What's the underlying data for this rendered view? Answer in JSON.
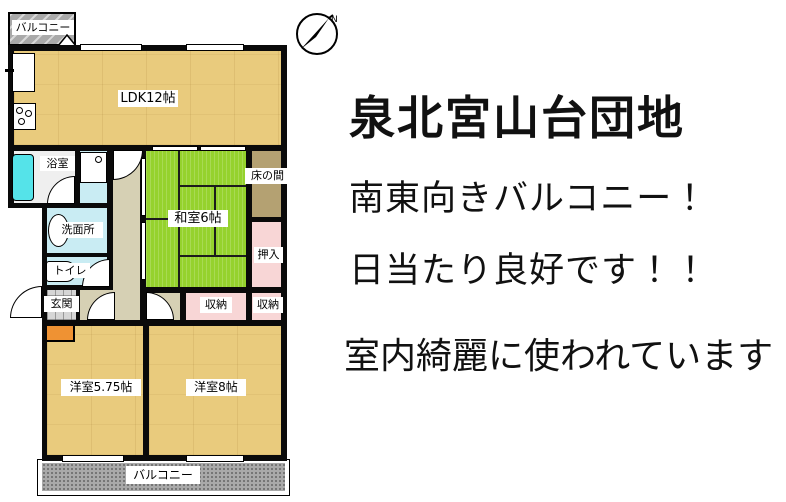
{
  "floorplan": {
    "rooms": {
      "balcony_top": {
        "label": "バルコニー"
      },
      "ldk": {
        "label": "LDK12帖"
      },
      "bath": {
        "label": "浴室"
      },
      "washroom": {
        "label": "洗面所"
      },
      "toilet": {
        "label": "トイレ"
      },
      "entrance": {
        "label": "玄関"
      },
      "washitsu": {
        "label": "和室6帖"
      },
      "tokonoma": {
        "label": "床の間"
      },
      "oshiire": {
        "label": "押入"
      },
      "storage_left": {
        "label": "収納"
      },
      "storage_right": {
        "label": "収納"
      },
      "bedroom_small": {
        "label": "洋室5.75帖"
      },
      "bedroom_large": {
        "label": "洋室8帖"
      },
      "balcony_bottom": {
        "label": "バルコニー"
      }
    },
    "compass": {
      "north_label": "N"
    },
    "colors": {
      "wood": "#e9cb7d",
      "tatami": "#95d22d",
      "pink": "#f8d6d6",
      "tokonoma": "#b4a172",
      "hallway": "#d6d0b4",
      "water": "#c9ecf3",
      "bathfloor": "#efefef",
      "tub": "#55e3e9",
      "balcony": "#a9a9a9",
      "tile": "#d6d6d6",
      "shoebox": "#ef9233"
    }
  },
  "description": {
    "title": "泉北宮山台団地",
    "line1": "南東向きバルコニー！",
    "line2": "日当たり良好です！！",
    "line3": "室内綺麗に使われています"
  }
}
